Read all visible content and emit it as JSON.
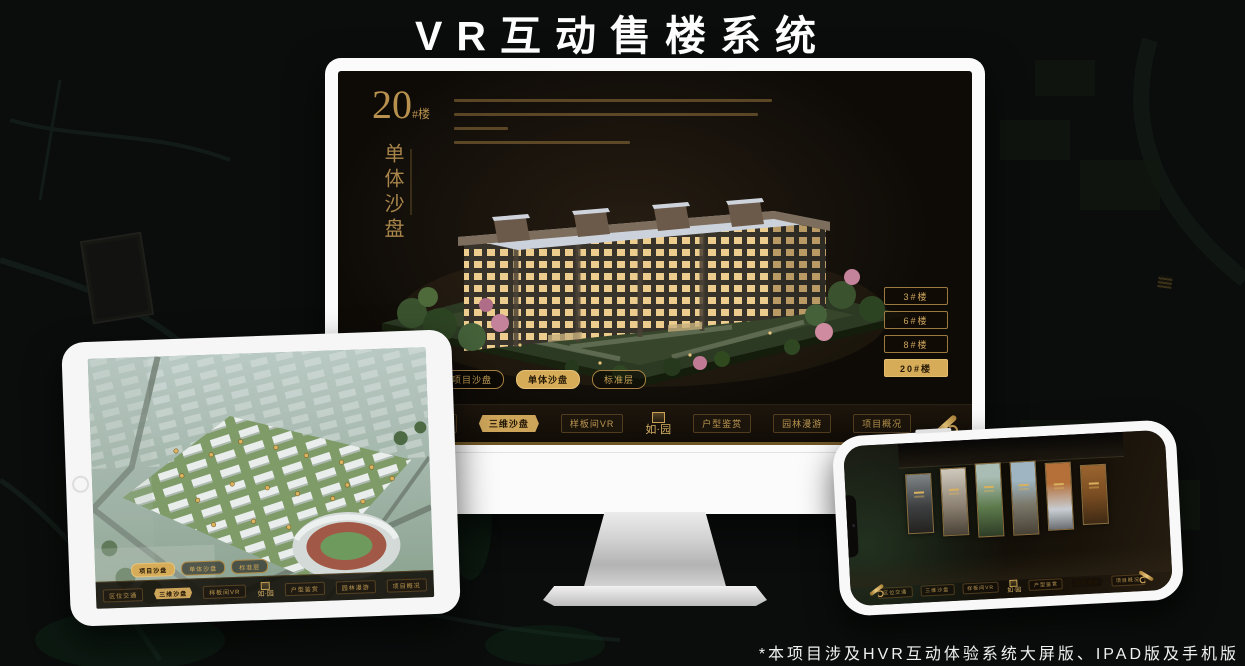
{
  "title": "VR互动售楼系统",
  "footnote": "*本项目涉及HVR互动体验系统大屏版、IPAD版及手机版",
  "colors": {
    "gold": "#c9a255",
    "gold_bright": "#e8c377",
    "screen_bg": "#0e0b07"
  },
  "desktop_app": {
    "block_number": "20",
    "block_number_suffix": "#楼",
    "block_subtitle_vertical": "单体沙盘",
    "floor_buttons": [
      "3#楼",
      "6#楼",
      "8#楼",
      "20#楼"
    ],
    "active_floor": "20#楼",
    "view_tabs": [
      "项目沙盘",
      "单体沙盘",
      "标准层"
    ],
    "active_view_tab": "单体沙盘"
  },
  "tablet_app": {
    "view_tabs": [
      "项目沙盘",
      "单体沙盘",
      "标准层"
    ],
    "active_view_tab": "项目沙盘"
  },
  "nav": {
    "logo": "如·园",
    "items": [
      "区位交通",
      "三维沙盘",
      "样板间VR",
      "户型鉴赏",
      "园林漫游",
      "项目概况"
    ],
    "active_on_desktop": "三维沙盘",
    "active_on_tablet": "三维沙盘",
    "active_on_phone": "园林漫游",
    "scroll_icon": "scroll-handle-icon"
  }
}
